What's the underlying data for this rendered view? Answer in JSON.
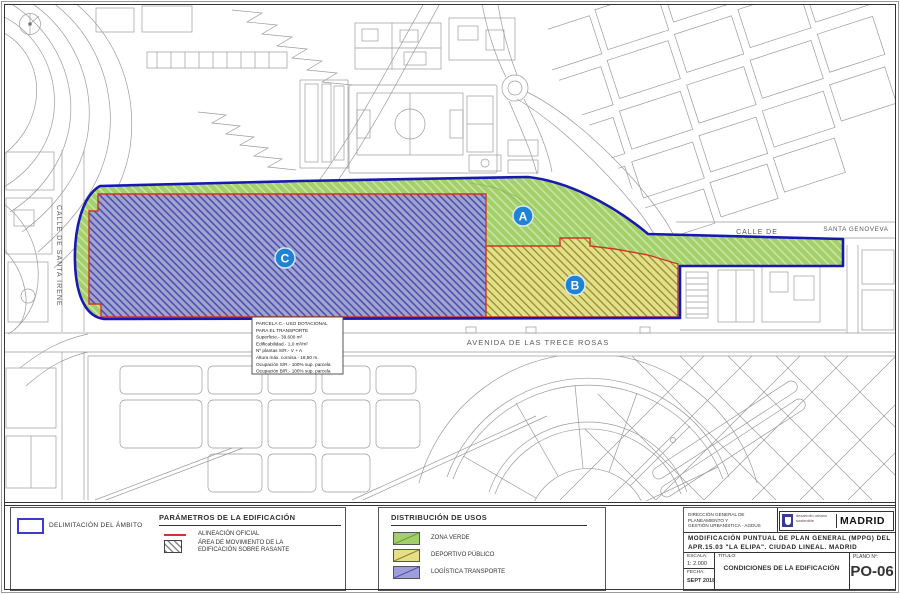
{
  "map": {
    "street_santa_irene": "CALLE DE SANTA IRENE",
    "street_calle_de": "CALLE DE",
    "street_santa_genoveva": "SANTA GENOVEVA",
    "street_avenida": "AVENIDA DE LAS TRECE ROSAS",
    "zone_a_label": "A",
    "zone_b_label": "B",
    "zone_c_label": "C",
    "parcel_note": {
      "lines": [
        "PARCELA C.- USO DOTACIONAL",
        "PARA EL TRANSPORTE",
        "Superficie.- 39.600 m²",
        "Edificabilidad.- 1,0 m²/m²",
        "Nº plantas S/R.- V + A",
        "Altura máx. cornisa.- 18,50 m.",
        "Ocupación S/R.- 100% sup. parcela",
        "Ocupación B/R.- 100% sup. parcela"
      ]
    }
  },
  "legend": {
    "ambito": {
      "label": "DELIMITACIÓN DEL ÁMBITO",
      "color": "#3c3cc8"
    },
    "parametros": {
      "title": "PARÁMETROS DE LA EDIFICACIÓN",
      "alineacion_label": "ALINEACIÓN OFICIAL",
      "alineacion_color": "#d23527",
      "area_line1": "ÁREA DE MOVIMIENTO DE LA",
      "area_line2": "EDIFICACIÓN SOBRE RASANTE"
    },
    "usos": {
      "title": "DISTRIBUCIÓN DE USOS",
      "items": [
        {
          "label": "ZONA VERDE",
          "color": "#a3d06a"
        },
        {
          "label": "DEPORTIVO PÚBLICO",
          "color": "#e6df87"
        },
        {
          "label": "LOGÍSTICA TRANSPORTE",
          "color": "#9e9eda"
        }
      ]
    }
  },
  "titleblock": {
    "org_line1": "DIRECCIÓN GENERAL DE PLANEAMIENTO Y",
    "org_line2": "GESTIÓN URBANÍSTICA - AGDUS",
    "logo": {
      "tagline_line1": "desarrollo urbano",
      "tagline_line2": "sostenible",
      "city": "MADRID"
    },
    "title_line1": "MODIFICACIÓN PUNTUAL DE PLAN GENERAL (MPPG) DEL",
    "title_line2": "APR.15.03 \"LA ELIPA\". CIUDAD LINEAL. MADRID",
    "escala_label": "ESCALA:",
    "escala_value": "1: 2.000",
    "fecha_label": "FECHA:",
    "fecha_value": "SEPT 2018",
    "titulo_label": "TÍTULO:",
    "titulo_value": "CONDICIONES DE LA EDIFICACIÓN",
    "plano_label": "PLANO Nº:",
    "plano_value": "PO-06"
  },
  "colors": {
    "zona_verde": "#a3d06a",
    "deportivo_publico": "#e6df87",
    "logistica_transporte": "#9e9eda",
    "delimitacion_ambito": "#1818b2",
    "alineacion_oficial": "#d23527",
    "zone_badge_blue": "#1e83d6",
    "map_lines": "#9b9b9b"
  }
}
